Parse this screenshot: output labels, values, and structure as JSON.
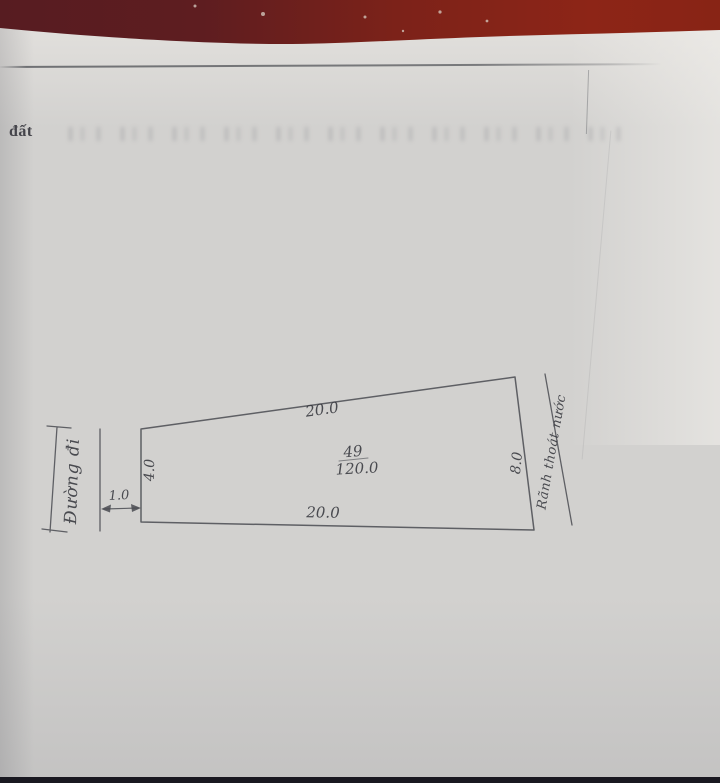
{
  "page": {
    "margin_label": "đất"
  },
  "sketch": {
    "parcel_number": "49",
    "area_value": "120.0",
    "top_edge": "20.0",
    "bottom_edge": "20.0",
    "left_edge": "4.0",
    "right_edge": "8.0",
    "road_width": "1.0",
    "road_label": "Đường đi",
    "drain_label": "Rãnh thoát nước"
  },
  "colors": {
    "table_red_dark": "#5e1d21",
    "table_red_bright": "#8d2517",
    "paper": "#d2d1cf",
    "pencil_ink": "#4a4b51",
    "bottom_strip": "#191820"
  }
}
